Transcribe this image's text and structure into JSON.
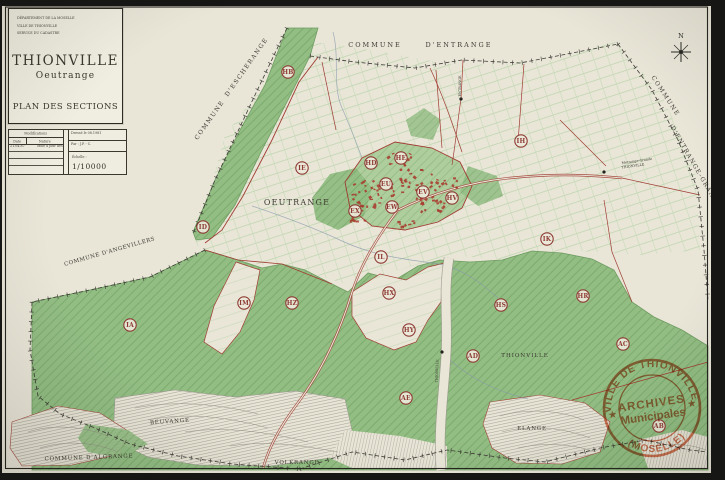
{
  "title_block": {
    "agency_lines": [
      "DÉPARTEMENT DE LA MOSELLE",
      "VILLE DE THIONVILLE",
      "SERVICE DU CADASTRE"
    ],
    "title": "THIONVILLE",
    "subtitle": "Oeutrange",
    "plan_label": "PLAN DES SECTIONS"
  },
  "revision_table": {
    "header": "Modifications",
    "col_date": "Date",
    "col_nature": "Nature",
    "row_date": "21.04.87",
    "row_nature": "Mise à jour des sections et lieux-dits",
    "drawn": "Dressé le 08.1981",
    "by": "Par : J.P. - C.",
    "scale_label": "Échelle :",
    "scale_value": "1/10000"
  },
  "compass": {
    "north_label": "N"
  },
  "stamp": {
    "top_text": "VILLE DE THIONVILLE",
    "bottom_text": "(MOSELLE)",
    "line1": "ARCHIVES",
    "line2": "Municipales",
    "star": "★",
    "color": "#d4603c"
  },
  "map": {
    "colors": {
      "paper": "#e9e6d8",
      "forest_green": "#92bd83",
      "field_line_green": "#afd0a0",
      "boundary_red": "#a03c32",
      "hatch_grey": "#97948a",
      "stamp_orange": "#d4603c"
    },
    "village_name": "OEUTRANGE",
    "sections": [
      {
        "code": "HB",
        "x": 288,
        "y": 72
      },
      {
        "code": "IE",
        "x": 302,
        "y": 168
      },
      {
        "code": "HD",
        "x": 371,
        "y": 163
      },
      {
        "code": "HE",
        "x": 401,
        "y": 158
      },
      {
        "code": "IH",
        "x": 521,
        "y": 141
      },
      {
        "code": "EU",
        "x": 386,
        "y": 184
      },
      {
        "code": "EV",
        "x": 423,
        "y": 192
      },
      {
        "code": "HV",
        "x": 452,
        "y": 198
      },
      {
        "code": "EW",
        "x": 392,
        "y": 207
      },
      {
        "code": "EX",
        "x": 355,
        "y": 211
      },
      {
        "code": "ID",
        "x": 203,
        "y": 227
      },
      {
        "code": "IK",
        "x": 547,
        "y": 239
      },
      {
        "code": "IL",
        "x": 381,
        "y": 257
      },
      {
        "code": "IM",
        "x": 244,
        "y": 303
      },
      {
        "code": "HZ",
        "x": 292,
        "y": 303
      },
      {
        "code": "HX",
        "x": 389,
        "y": 293
      },
      {
        "code": "HS",
        "x": 501,
        "y": 305
      },
      {
        "code": "HR",
        "x": 583,
        "y": 296
      },
      {
        "code": "IA",
        "x": 130,
        "y": 325
      },
      {
        "code": "HY",
        "x": 409,
        "y": 330
      },
      {
        "code": "AC",
        "x": 623,
        "y": 344
      },
      {
        "code": "AD",
        "x": 473,
        "y": 356
      },
      {
        "code": "AE",
        "x": 406,
        "y": 398
      },
      {
        "code": "AB",
        "x": 659,
        "y": 426
      }
    ],
    "labels": [
      {
        "text": "COMMUNE",
        "x": 375,
        "y": 47,
        "r": 0,
        "s": 6.5,
        "ls": 2
      },
      {
        "text": "D'ENTRANGE",
        "x": 459,
        "y": 47,
        "r": 0,
        "s": 6.5,
        "ls": 2
      },
      {
        "text": "COMMUNE",
        "x": 211,
        "y": 121,
        "r": -55,
        "s": 6,
        "ls": 1.5
      },
      {
        "text": "D'ESCHERANGE",
        "x": 248,
        "y": 68,
        "r": -55,
        "s": 6,
        "ls": 1.5
      },
      {
        "text": "COMMUNE  D'ANGEVILLERS",
        "x": 110,
        "y": 253,
        "r": -16,
        "s": 5.5,
        "ls": 0.5
      },
      {
        "text": "COMMUNE  D'ALGRANGE",
        "x": 89,
        "y": 459,
        "r": -2,
        "s": 5.5,
        "ls": 0.8
      },
      {
        "text": "COMMUNE",
        "x": 664,
        "y": 97,
        "r": 57,
        "s": 6,
        "ls": 1.5
      },
      {
        "text": "D'ENTRANGE-GRANDE",
        "x": 694,
        "y": 168,
        "r": 60,
        "s": 6,
        "ls": 1.2
      },
      {
        "text": "OEUTRANGE",
        "x": 297,
        "y": 205,
        "r": 0,
        "s": 8,
        "ls": 1.2
      },
      {
        "text": "THIONVILLE",
        "x": 525,
        "y": 357,
        "r": 0,
        "s": 5.5,
        "ls": 1
      },
      {
        "text": "BEUVANGE",
        "x": 170,
        "y": 423,
        "r": -4,
        "s": 5.5,
        "ls": 0.8
      },
      {
        "text": "VOLKRANGE",
        "x": 297,
        "y": 464,
        "r": 0,
        "s": 5.5,
        "ls": 0.8
      },
      {
        "text": "ELANGE",
        "x": 532,
        "y": 430,
        "r": 0,
        "s": 5.5,
        "ls": 0.8
      },
      {
        "text": "Metzange-Grande",
        "x": 637,
        "y": 162,
        "r": -8,
        "s": 3.4,
        "ls": 0
      },
      {
        "text": "THIONVILLE",
        "x": 633,
        "y": 167,
        "r": -8,
        "s": 3.4,
        "ls": 0
      },
      {
        "text": "ENTRANGE",
        "x": 461,
        "y": 86,
        "r": -90,
        "s": 3.4,
        "ls": 0
      },
      {
        "text": "THIONVILLE",
        "x": 438,
        "y": 371,
        "r": -88,
        "s": 3.4,
        "ls": 0
      }
    ],
    "poi_dots": [
      {
        "x": 604,
        "y": 172
      },
      {
        "x": 461,
        "y": 99
      },
      {
        "x": 442,
        "y": 352
      }
    ]
  }
}
